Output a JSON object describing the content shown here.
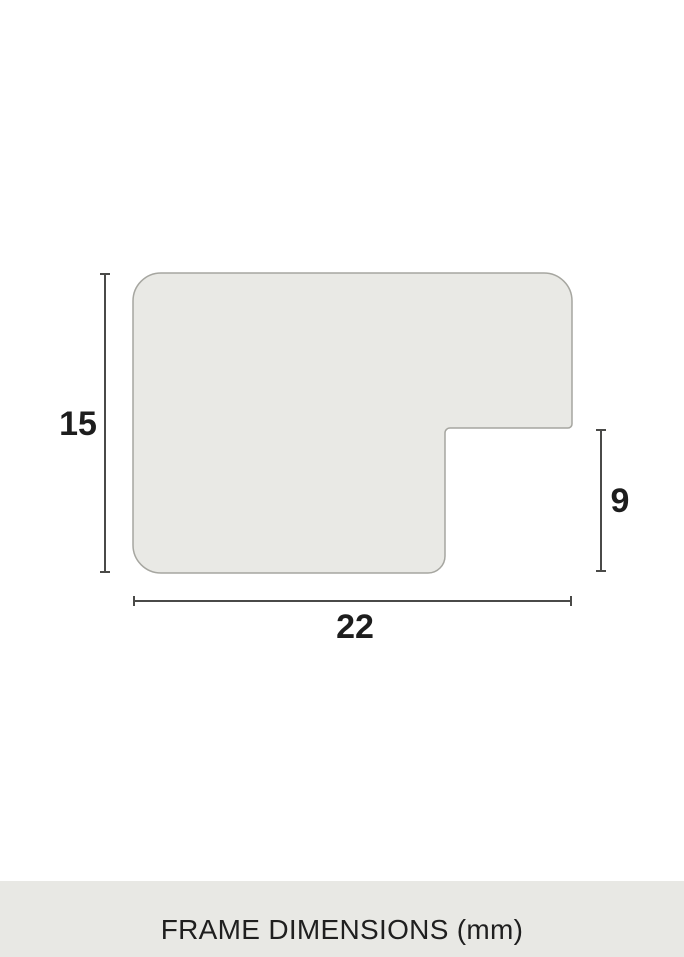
{
  "diagram": {
    "labels": {
      "height": "15",
      "width": "22",
      "rabbet_height": "9"
    },
    "colors": {
      "profile_fill": "#e9e9e5",
      "profile_stroke": "#a6a6a0",
      "dimension_line": "#4a4a48",
      "label_text": "#1d1d1d"
    }
  },
  "footer": {
    "caption": "FRAME DIMENSIONS (mm)",
    "colors": {
      "background": "#e8e8e4",
      "text": "#1f1f1f"
    }
  }
}
